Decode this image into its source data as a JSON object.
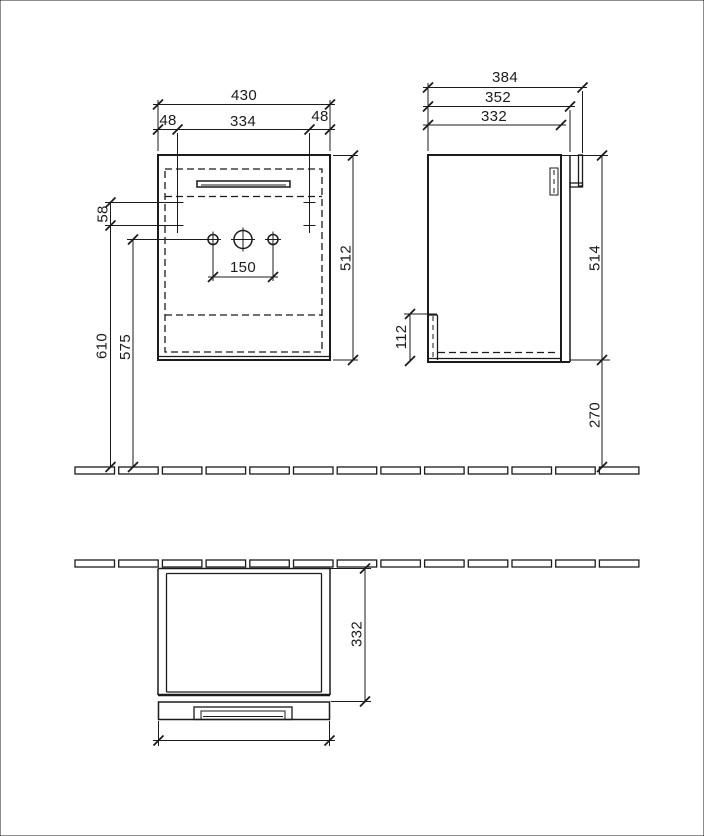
{
  "drawing": {
    "type": "furniture dimensional drawing",
    "unit": "mm",
    "colors": {
      "line": "#1b1b1b",
      "background": "#ffffff"
    },
    "views": {
      "front": {
        "label": "front view",
        "dims": {
          "width_total": "430",
          "offset_left": "48",
          "mount_hole_spacing": "334",
          "offset_right": "48",
          "mount_row_gap": "58",
          "height_carcass": "512",
          "tap_hole_spacing": "150",
          "height_mount_from_floor": "610",
          "height_tap_from_floor": "575"
        }
      },
      "side": {
        "label": "side view",
        "dims": {
          "depth_total_with_handle": "384",
          "depth_with_door": "352",
          "depth_carcass": "332",
          "height_carcass": "514",
          "rear_rail_height": "112",
          "floor_clearance": "270"
        }
      },
      "plan": {
        "label": "top view",
        "dims": {
          "depth_carcass": "332",
          "width_door": "428"
        }
      }
    }
  }
}
